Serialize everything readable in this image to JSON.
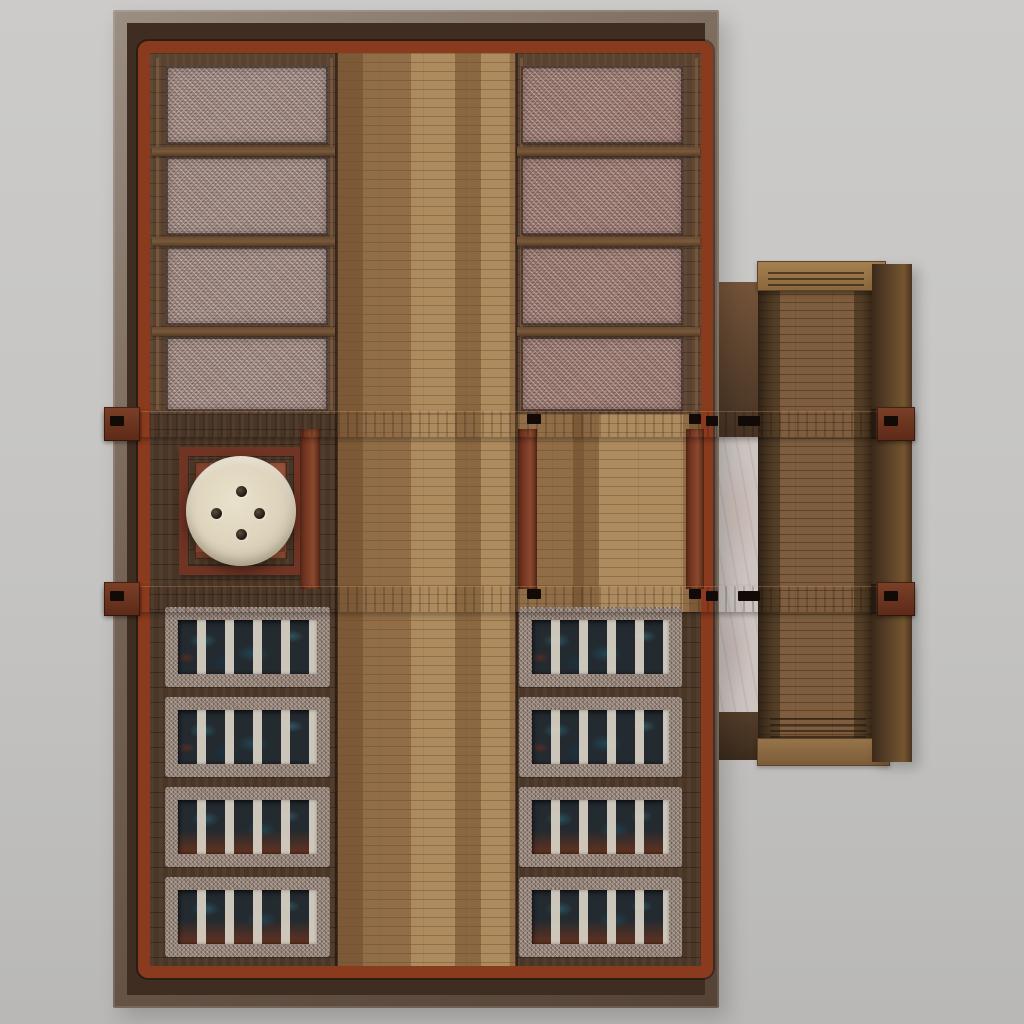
{
  "meta": {
    "scene": "top-down 3d render of a wooden bathhouse interior with a right-side annex room",
    "visible_text": "none"
  },
  "colors": {
    "bg-top": "#cccbc9",
    "bg-bot": "#b9b8b6",
    "wall-light": "#9b8e82",
    "wall-mid": "#756455",
    "wall-dark": "#544336",
    "wall-band": "#3f2d22",
    "frame-red": "#8a3a1d",
    "beam-hi": "#8a4a2e",
    "beam-mid": "#7b3a25",
    "beam-lo": "#5f2b19",
    "post-red": "#7c3b26",
    "wood-dark": "#5a4230",
    "wood-darker": "#4a3626",
    "walk-base": "#ae8b5e",
    "walk-dash": "#6d4a2a",
    "gravel-pink": "#a6908a",
    "gravel-red": "#a18078",
    "gravel-tan": "#97867b",
    "pool-dark": "#232a30",
    "pool-teal": "#2f7c8c",
    "slat": "#d7d0c3",
    "ember": "#7e2f18",
    "tub-cream": "#ded4bd",
    "tub-edge": "#a89d84",
    "dot-dark": "#241c14",
    "tile-a": "#a25a3e",
    "tile-b": "#8a4832",
    "platform-frame": "#6f3423",
    "marble": "#cbc4c0",
    "steel": "#98948d",
    "annex-floor": "#7e5e3e",
    "annex-cap": "#a5804f",
    "sep-bar": "#7a593b"
  },
  "scene": {
    "background": {
      "label": "plain gray backdrop"
    },
    "main_building": {
      "walls": "dark timber shell with red lacquered inner frame",
      "central_walkway": "light parquet plank strip, full height",
      "upper_left_gravel_beds": {
        "count": 4,
        "material": "pink-gray gravel"
      },
      "upper_right_gravel_beds": {
        "count": 4,
        "material": "red-pink gravel"
      },
      "cross_beams": {
        "count": 2,
        "material": "red timber, notched, protruding both ends"
      },
      "support_posts": {
        "count": 3
      },
      "stove_corner": {
        "platform": "red timber frame over red brick tiles",
        "basin": "round cream stone basin",
        "vent_holes": 4
      },
      "lower_left_pools": {
        "count": 4,
        "slats_per_pool": 5,
        "material": "dark teal water, pale board slats, gravel border"
      },
      "lower_right_pools": {
        "count": 4,
        "slats_per_pool": 5,
        "material": "dark teal water, pale board slats, gravel border, ember glow in lower rows"
      }
    },
    "annex": {
      "position": "attached right side",
      "floor": "medium wood planks",
      "left_passage": "white marble strip with steel edge",
      "top_cap": "light wood rail with slats",
      "bottom_cap": "light wood rail with slats",
      "right_wall": "dark timber"
    }
  }
}
